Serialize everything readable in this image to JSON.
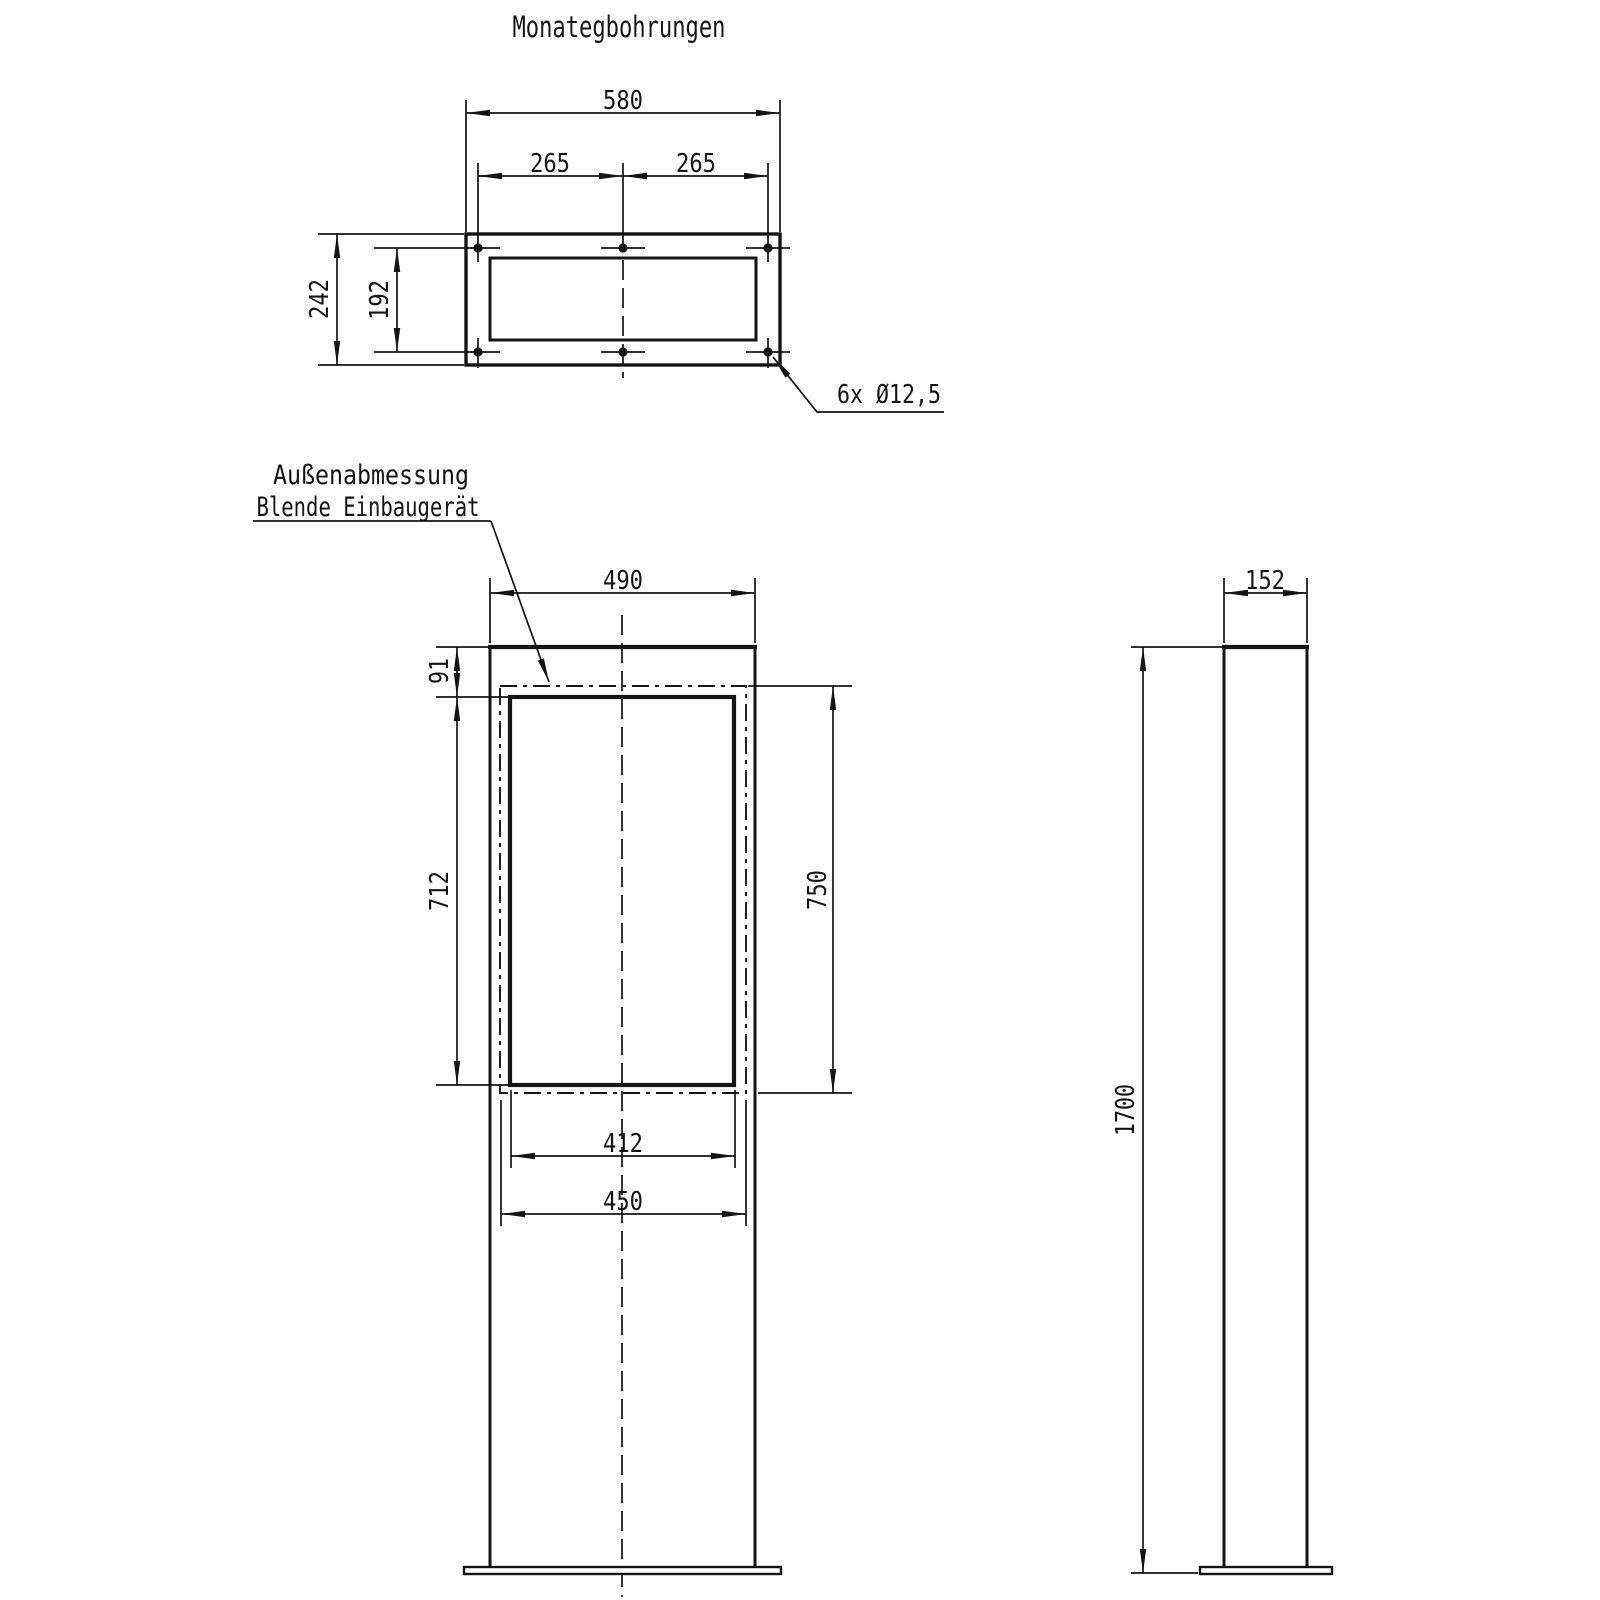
{
  "drawing": {
    "title": "Monategbohrungen",
    "note_line1": "Außenabmessung",
    "note_line2": "Blende Einbaugerät",
    "ink_color": "#141414",
    "background_color": "#ffffff",
    "top_view": {
      "width_overall": "580",
      "hole_spacing_left": "265",
      "hole_spacing_right": "265",
      "height_overall": "242",
      "hole_row_spacing": "192",
      "holes_label": "6x Ø12,5"
    },
    "front_view": {
      "width_overall": "490",
      "top_offset": "91",
      "window_height": "712",
      "blende_height": "750",
      "window_width": "412",
      "blende_width": "450"
    },
    "side_view": {
      "depth": "152",
      "height_overall": "1700"
    }
  }
}
